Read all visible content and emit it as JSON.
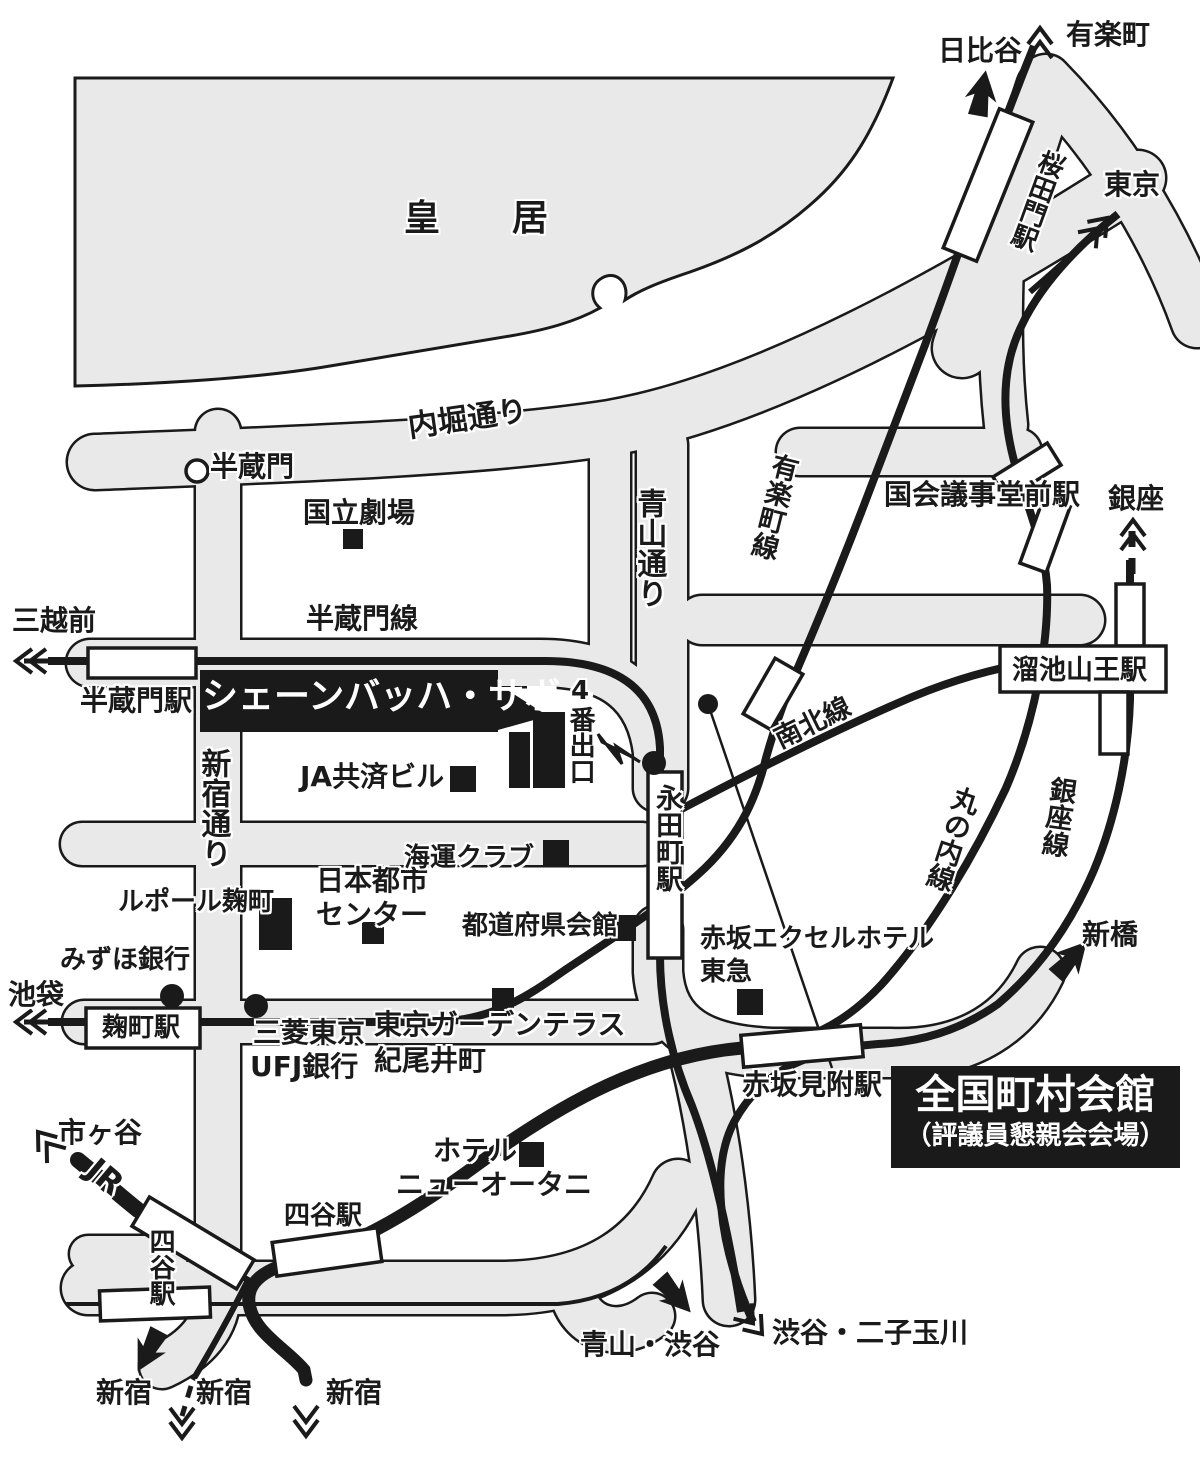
{
  "colors": {
    "road": "#e9e9e9",
    "ink": "#1a1a1a",
    "background": "#ffffff",
    "plate": "#1a1a1a",
    "plate_text": "#ffffff"
  },
  "labels": {
    "kokyo": "皇　居",
    "hanzomon_gate": "半蔵門",
    "uchibori_dori": "内堀通り",
    "kokuritsu_gekijo": "国立劇場",
    "hibiya": "日比谷",
    "yurakucho": "有楽町",
    "tokyo": "東京",
    "sakuradamon_sta": "桜田門駅",
    "ginza": "銀座",
    "kokkaigijidomae_sta": "国会議事堂前駅",
    "mitsukoshimae": "三越前",
    "hanzomon_line": "半蔵門線",
    "hanzomon_sta": "半蔵門駅",
    "schoenbach_sabo": "シェーンバッハ・サボー",
    "exit4": "4番出口",
    "ja_kyosai": "JA共済ビル",
    "shinjuku_dori": "新宿通り",
    "aoyama_dori": "青山通り",
    "yurakucho_line": "有楽町線",
    "tameike_sanno_sta": "溜池山王駅",
    "nagatacho_sta": "永田町駅",
    "nanboku_line": "南北線",
    "marunouchi_line": "丸の内線",
    "ginza_line": "銀座線",
    "shimbashi": "新橋",
    "leport_kojimachi": "ルポール麹町",
    "nihon_toshi_1": "日本都市",
    "nihon_toshi_2": "センター",
    "kaiun_club": "海運クラブ",
    "todofuken_kaikan": "都道府県会館",
    "mizuho_bank": "みずほ銀行",
    "ikebukuro": "池袋",
    "kojimachi_sta": "麹町駅",
    "ufj_1": "三菱東京",
    "ufj_2": "UFJ銀行",
    "garden_terrace_1": "東京ガーデンテラス",
    "garden_terrace_2": "紀尾井町",
    "akasaka_excel_1": "赤坂エクセルホテル",
    "akasaka_excel_2": "東急",
    "akasaka_mitsuke_sta": "赤坂見附駅",
    "zenkoku_kaikan": "全国町村会館",
    "zenkoku_note": "（評議員懇親会会場）",
    "hotel_1": "ホテル",
    "hotel_2": "ニューオータニ",
    "yotsuya_sta": "四谷駅",
    "jr": "JR",
    "ichigaya": "市ヶ谷",
    "shinjuku": "新宿",
    "aoyama_shibuya": "青山・渋谷",
    "shibuya_futako": "渋谷・二子玉川"
  }
}
